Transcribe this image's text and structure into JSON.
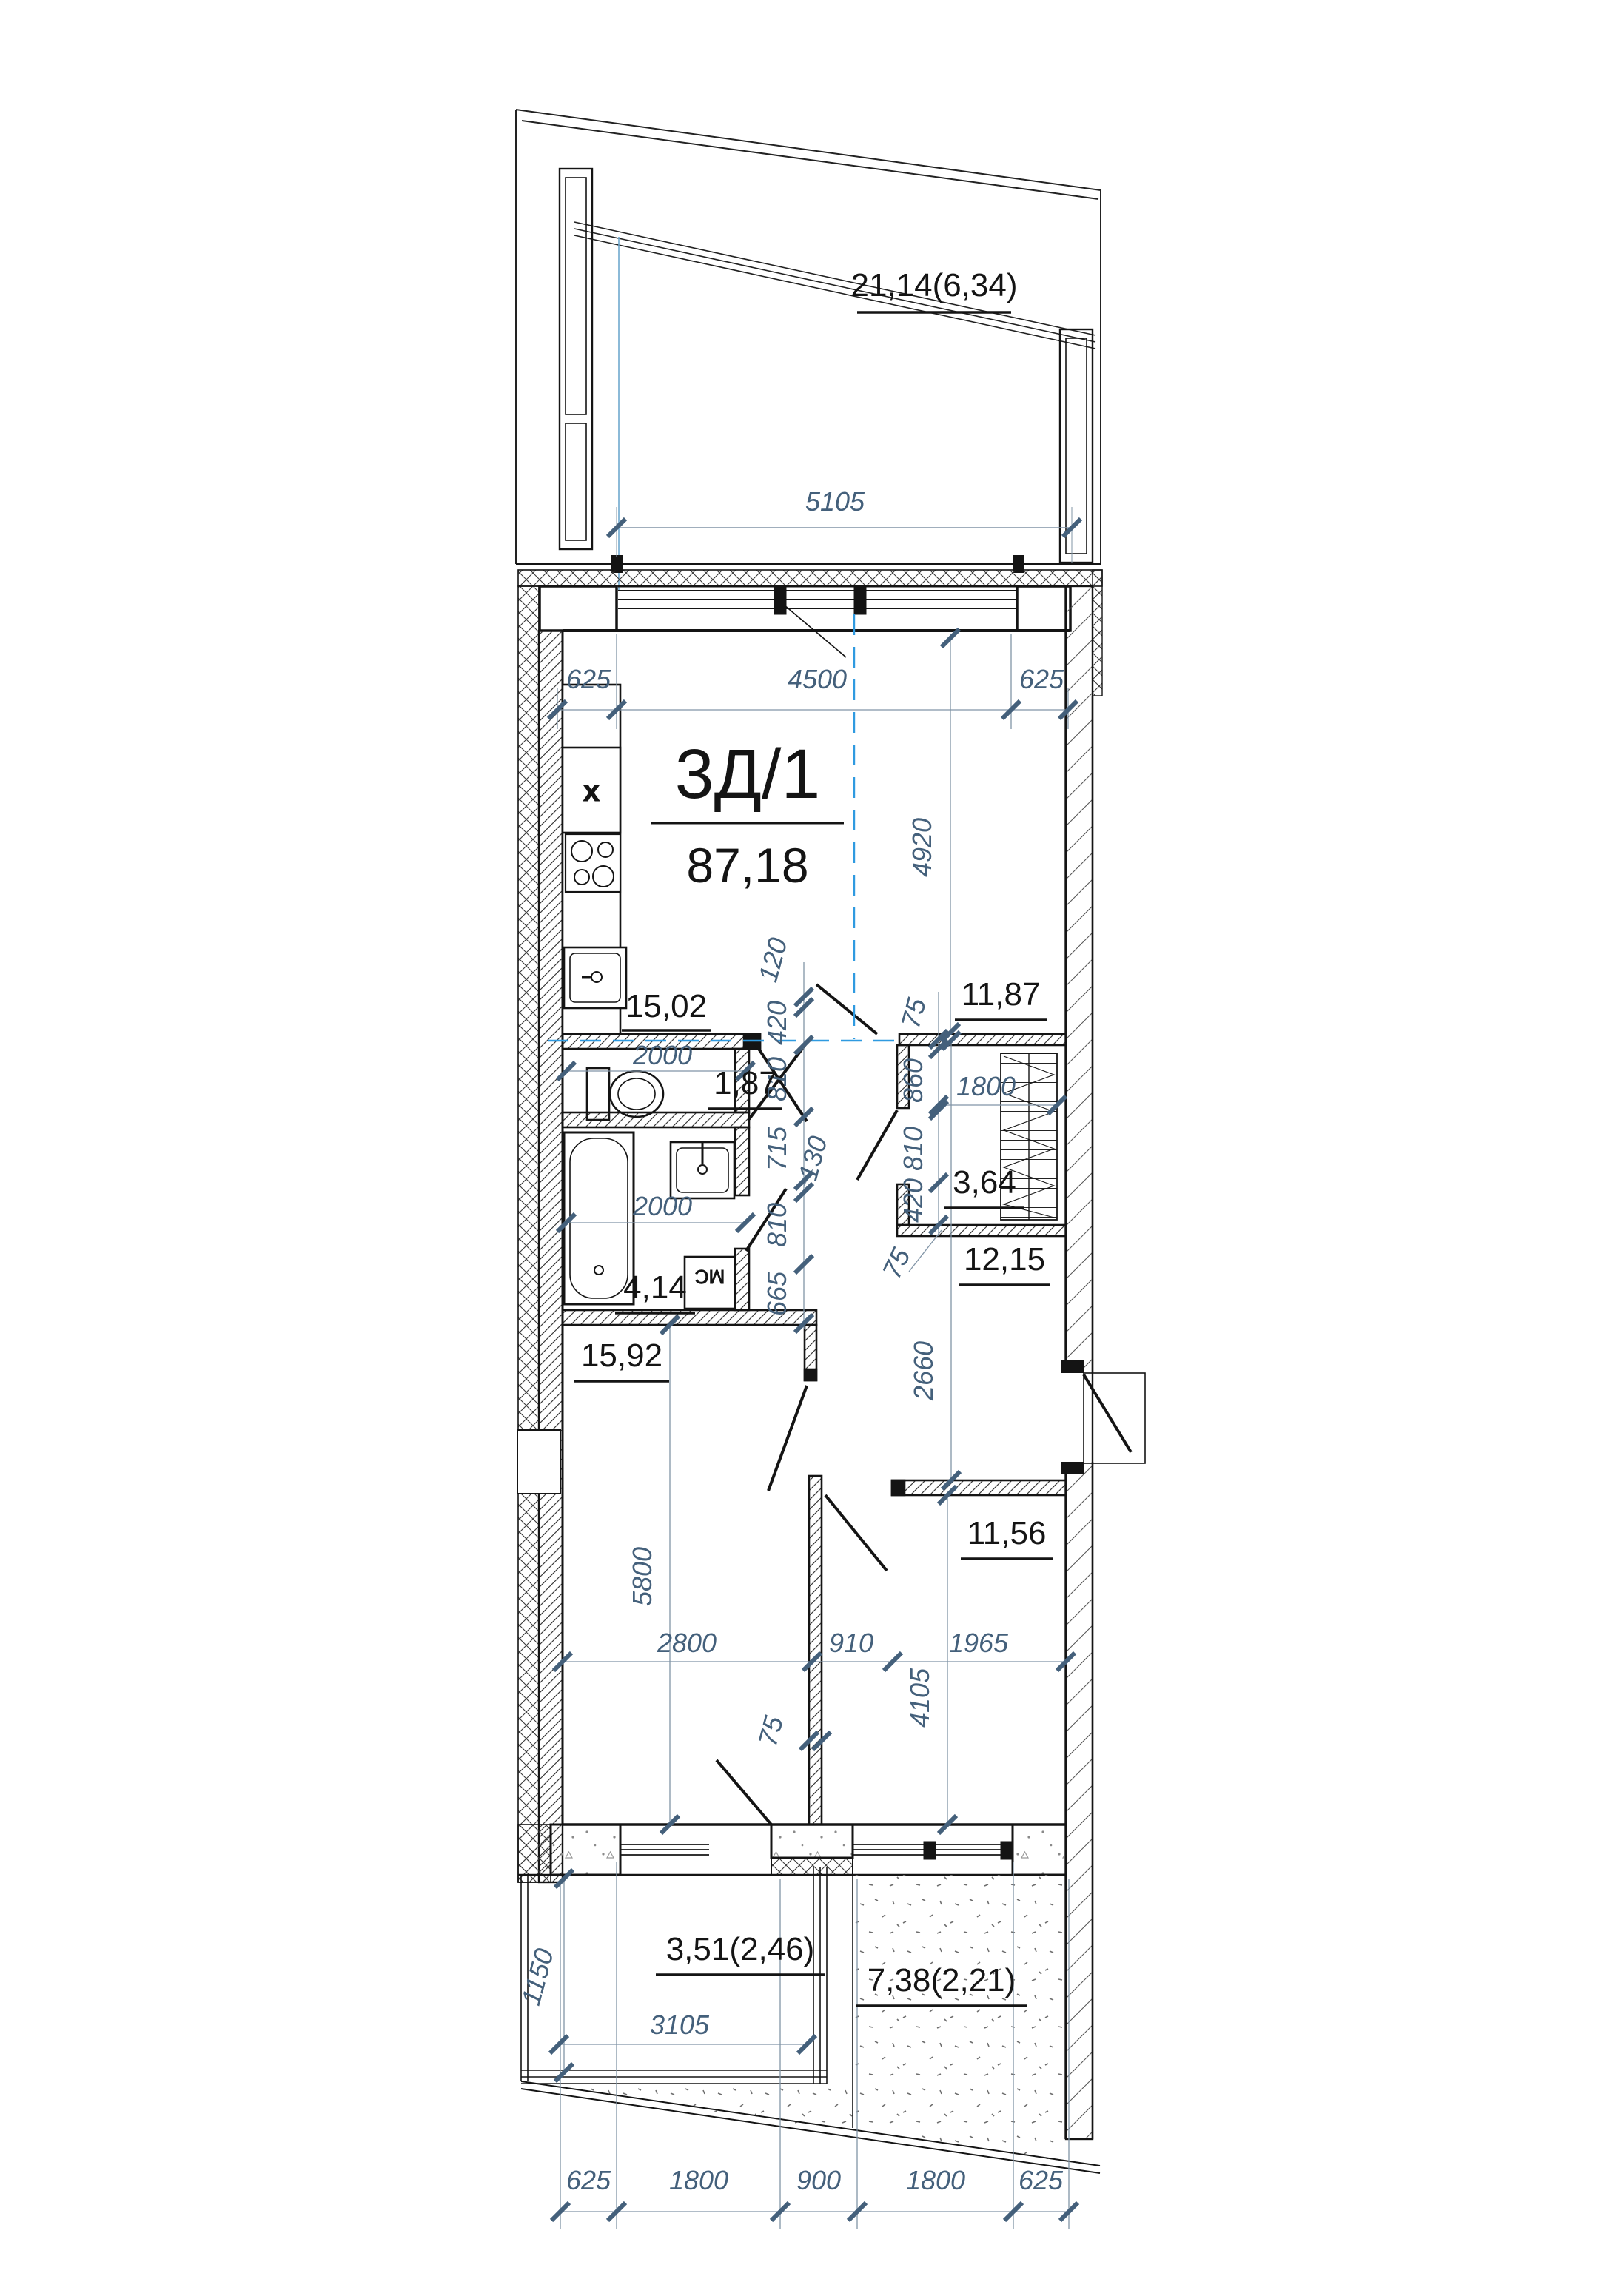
{
  "unit": {
    "code": "3Д/1",
    "area": "87,18"
  },
  "rooms": {
    "balcony_top": "21,14(6,34)",
    "kitchen": "15,02",
    "room_right": "11,87",
    "wc": "1,87",
    "bath": "4,14",
    "wardrobe": "3,64",
    "hall": "12,15",
    "bedroom_left": "15,92",
    "bedroom_right": "11,56",
    "loggia": "3,51(2,46)",
    "terrace": "7,38(2,21)"
  },
  "dims": {
    "balcony_w": "5105",
    "off_l": "625",
    "win_top": "4500",
    "off_r": "625",
    "room_right_h": "4920",
    "wc_w": "2000",
    "bath_w": "2000",
    "c120": "120",
    "c420": "420",
    "c810": "810",
    "c715": "715",
    "c130": "130",
    "c665": "665",
    "c75": "75",
    "c860": "860",
    "wardrobe_rail": "1800",
    "hall_h": "2660",
    "bed_l_h": "5800",
    "bed_l_w": "2800",
    "door_w": "910",
    "bed_r_w": "1965",
    "bed_r_h": "4105",
    "part": "75",
    "loggia_d": "1150",
    "loggia_w": "3105",
    "b1": "625",
    "b2": "1800",
    "b3": "900",
    "b4": "1800",
    "b5": "625"
  },
  "fixtures": {
    "washer": "МС",
    "vent": "x"
  },
  "colors": {
    "line": "#141414",
    "dim": "#44607b",
    "axis_blue": "#2f9ae0"
  }
}
